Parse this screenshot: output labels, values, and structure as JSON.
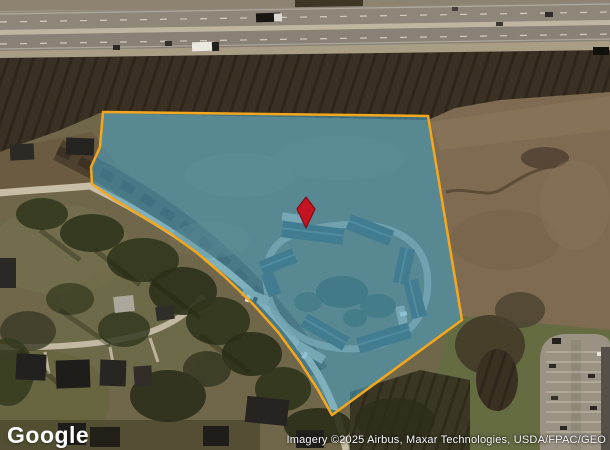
{
  "map": {
    "logo": "Google",
    "attribution": "Imagery ©2025 Airbus, Maxar Technologies, USDA/FPAC/GEO",
    "parcel": {
      "points": "103,112 428,116 462,320 332,415 318,390 300,362 278,332 252,303 224,276 196,252 168,232 140,215 115,200 92,184 91,167 100,147",
      "fill": "rgba(70,165,205,0.55)",
      "stroke": "#F4A71C"
    },
    "marker": {
      "points": "306,197 315,209 306,228 297,209",
      "fill": "#C41323",
      "stroke": "#7E0E16"
    }
  }
}
